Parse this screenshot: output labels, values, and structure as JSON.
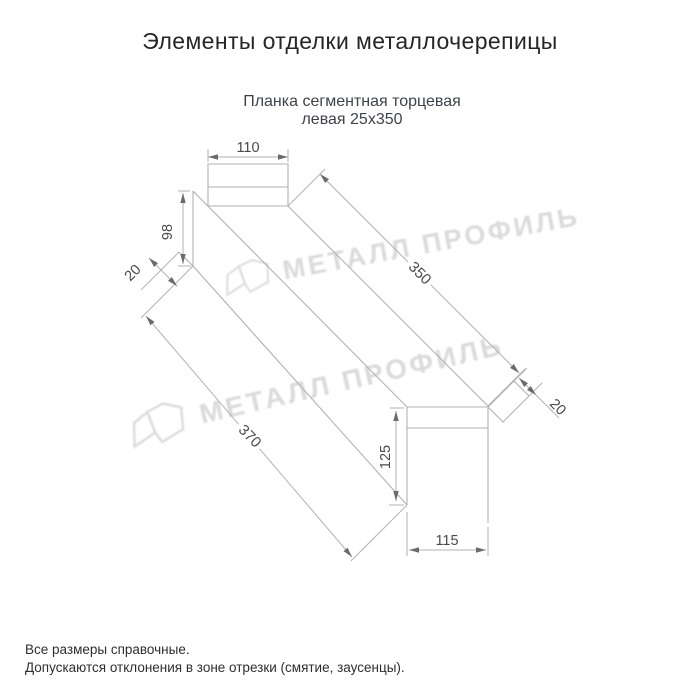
{
  "title": "Элементы отделки металлочерепицы",
  "product": {
    "name_line1": "Планка сегментная торцевая",
    "name_line2": "левая 25х350"
  },
  "dims": {
    "d110": "110",
    "d98": "98",
    "d20_top": "20",
    "d350": "350",
    "d370": "370",
    "d20_right": "20",
    "d125": "125",
    "d115": "115"
  },
  "watermark": {
    "brand": "МЕТАЛЛ ПРОФИЛЬ"
  },
  "notes": {
    "line1": "Все размеры справочные.",
    "line2": "Допускаются отклонения в зоне отрезки (смятие, заусенцы)."
  },
  "colors": {
    "line": "#b2b2b2",
    "dim_text": "#4a4a4a",
    "arrow": "#6b6b6b",
    "title_text": "#262626",
    "subtitle_text": "#3e434b",
    "watermark": "#c3c3c3",
    "background": "#ffffff"
  }
}
